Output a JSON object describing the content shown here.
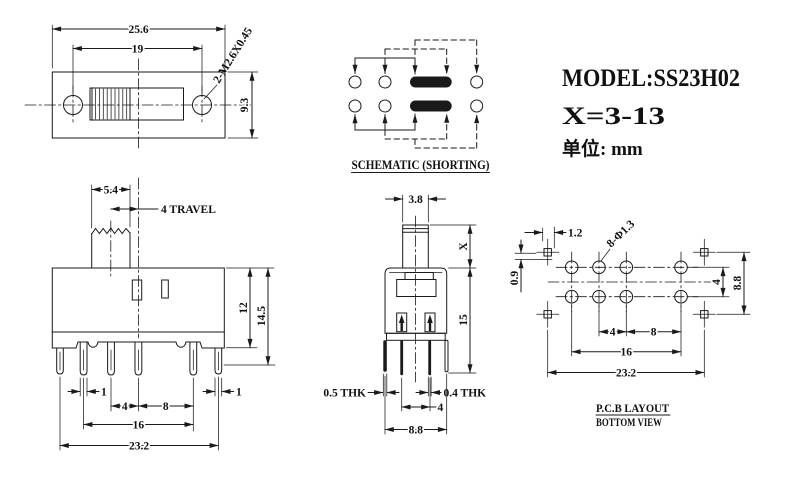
{
  "title_block": {
    "model": "MODEL:SS23H02",
    "x_range": "X=3-13",
    "unit": "单位: mm"
  },
  "front_view": {
    "dims": {
      "width": "25.6",
      "hole_pitch": "19",
      "height": "9.3",
      "thread": "2-M2.6X0.45"
    }
  },
  "schematic": {
    "caption": "SCHEMATIC (SHORTING)"
  },
  "side_view": {
    "dims": {
      "knob_width": "5.4",
      "travel": "4 TRAVEL",
      "body_height": "12",
      "overall_height": "14.5",
      "pin_width_left": "1",
      "pin_width_right": "1",
      "pitch_a": "4",
      "pitch_b": "8",
      "span": "16",
      "overall_width": "23.2"
    }
  },
  "profile_view": {
    "dims": {
      "knob_thickness": "3.8",
      "stem_height": "X",
      "body_height": "15",
      "thk_left": "0.5 THK",
      "thk_right": "0.4 THK",
      "row_pitch": "4",
      "overall_depth": "8.8"
    }
  },
  "pcb_layout": {
    "caption_line1": "P.C.B LAYOUT",
    "caption_line2": "BOTTOM VIEW",
    "dims": {
      "pad_offset_x": "1.2",
      "pad_offset_y": "0.9",
      "hole_spec": "8-Φ1.3",
      "row_pitch": "4",
      "pad_row_span": "8.8",
      "pitch_a": "4",
      "pitch_b": "8",
      "span": "16",
      "overall": "23.2"
    }
  }
}
